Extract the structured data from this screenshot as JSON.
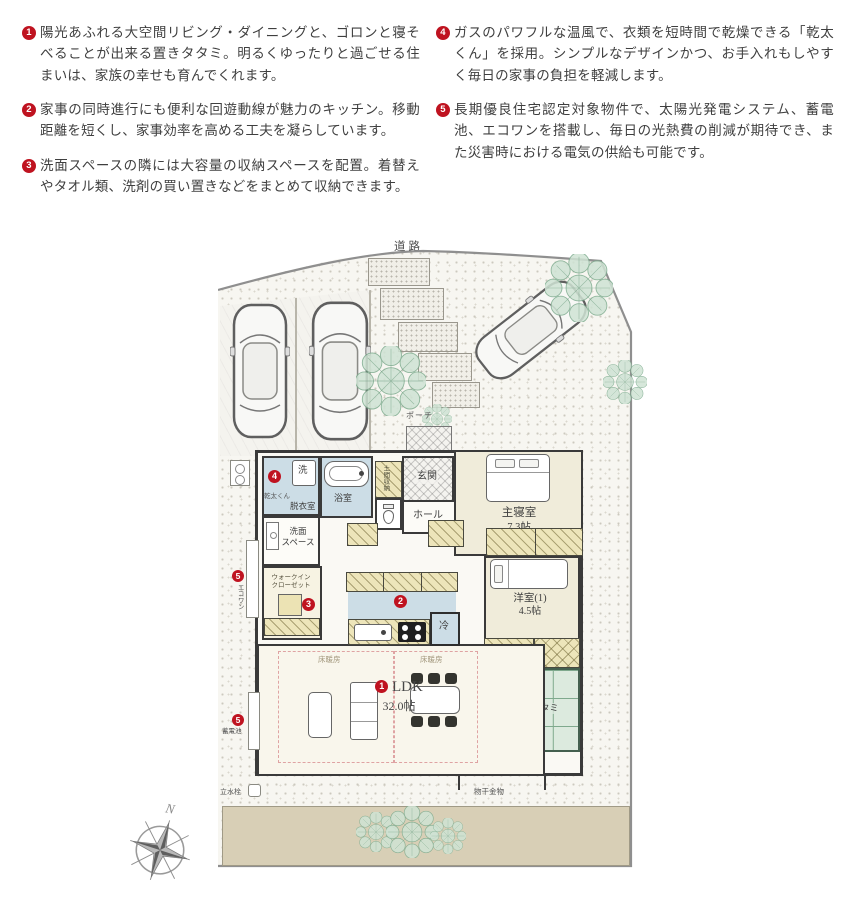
{
  "notes": {
    "items": [
      {
        "num": "1",
        "text": "陽光あふれる大空間リビング・ダイニングと、ゴロンと寝そべることが出来る置きタタミ。明るくゆったりと過ごせる住まいは、家族の幸せも育んでくれます。"
      },
      {
        "num": "2",
        "text": "家事の同時進行にも便利な回遊動線が魅力のキッチン。移動距離を短くし、家事効率を高める工夫を凝らしています。"
      },
      {
        "num": "3",
        "text": "洗面スペースの隣には大容量の収納スペースを配置。着替えやタオル類、洗剤の買い置きなどをまとめて収納できます。"
      },
      {
        "num": "4",
        "text": "ガスのパワフルな温風で、衣類を短時間で乾燥できる「乾太くん」を採用。シンプルなデザインかつ、お手入れもしやすく毎日の家事の負担を軽減します。"
      },
      {
        "num": "5",
        "text": "長期優良住宅認定対象物件で、太陽光発電システム、蓄電池、エコワンを搭載し、毎日の光熱費の削減が期待でき、また災害時における電気の供給も可能です。"
      }
    ]
  },
  "plan": {
    "road": "道路",
    "porch": "ポーチ",
    "genkan": "玄関",
    "hall": "ホール",
    "doma": "土間収納",
    "bath": "浴室",
    "washer": "洗",
    "kanta": "乾太くん",
    "datsui": "脱衣室",
    "senmen_1": "洗面",
    "senmen_2": "スペース",
    "wic_1": "ウォークイン",
    "wic_2": "クローゼット",
    "bedroom_name": "主寝室",
    "bedroom_size": "7.3帖",
    "yoshitsu_name": "洋室(1)",
    "yoshitsu_size": "4.5帖",
    "ldk_name": "LDK",
    "ldk_size": "32.0帖",
    "yukadanbo": "床暖房",
    "tatami": "置きタタミ",
    "fridge": "冷",
    "ecoone": "エコワン",
    "battery": "蓄電池",
    "monohoshi": "物干金物",
    "rissuisen": "立水栓",
    "markers": {
      "m1": "1",
      "m2": "2",
      "m3": "3",
      "m4": "4",
      "m5": "5"
    }
  },
  "compass": {
    "north": "N"
  },
  "colors": {
    "accent_red": "#bf1320",
    "wall": "#3a3a3a",
    "tatami_green": "#7fa98d",
    "wet_area_blue": "#ccdde6",
    "closet_yellow": "#ede5ba",
    "ground_tan": "#d8cfb6",
    "tree_green": "#7dab8e"
  }
}
